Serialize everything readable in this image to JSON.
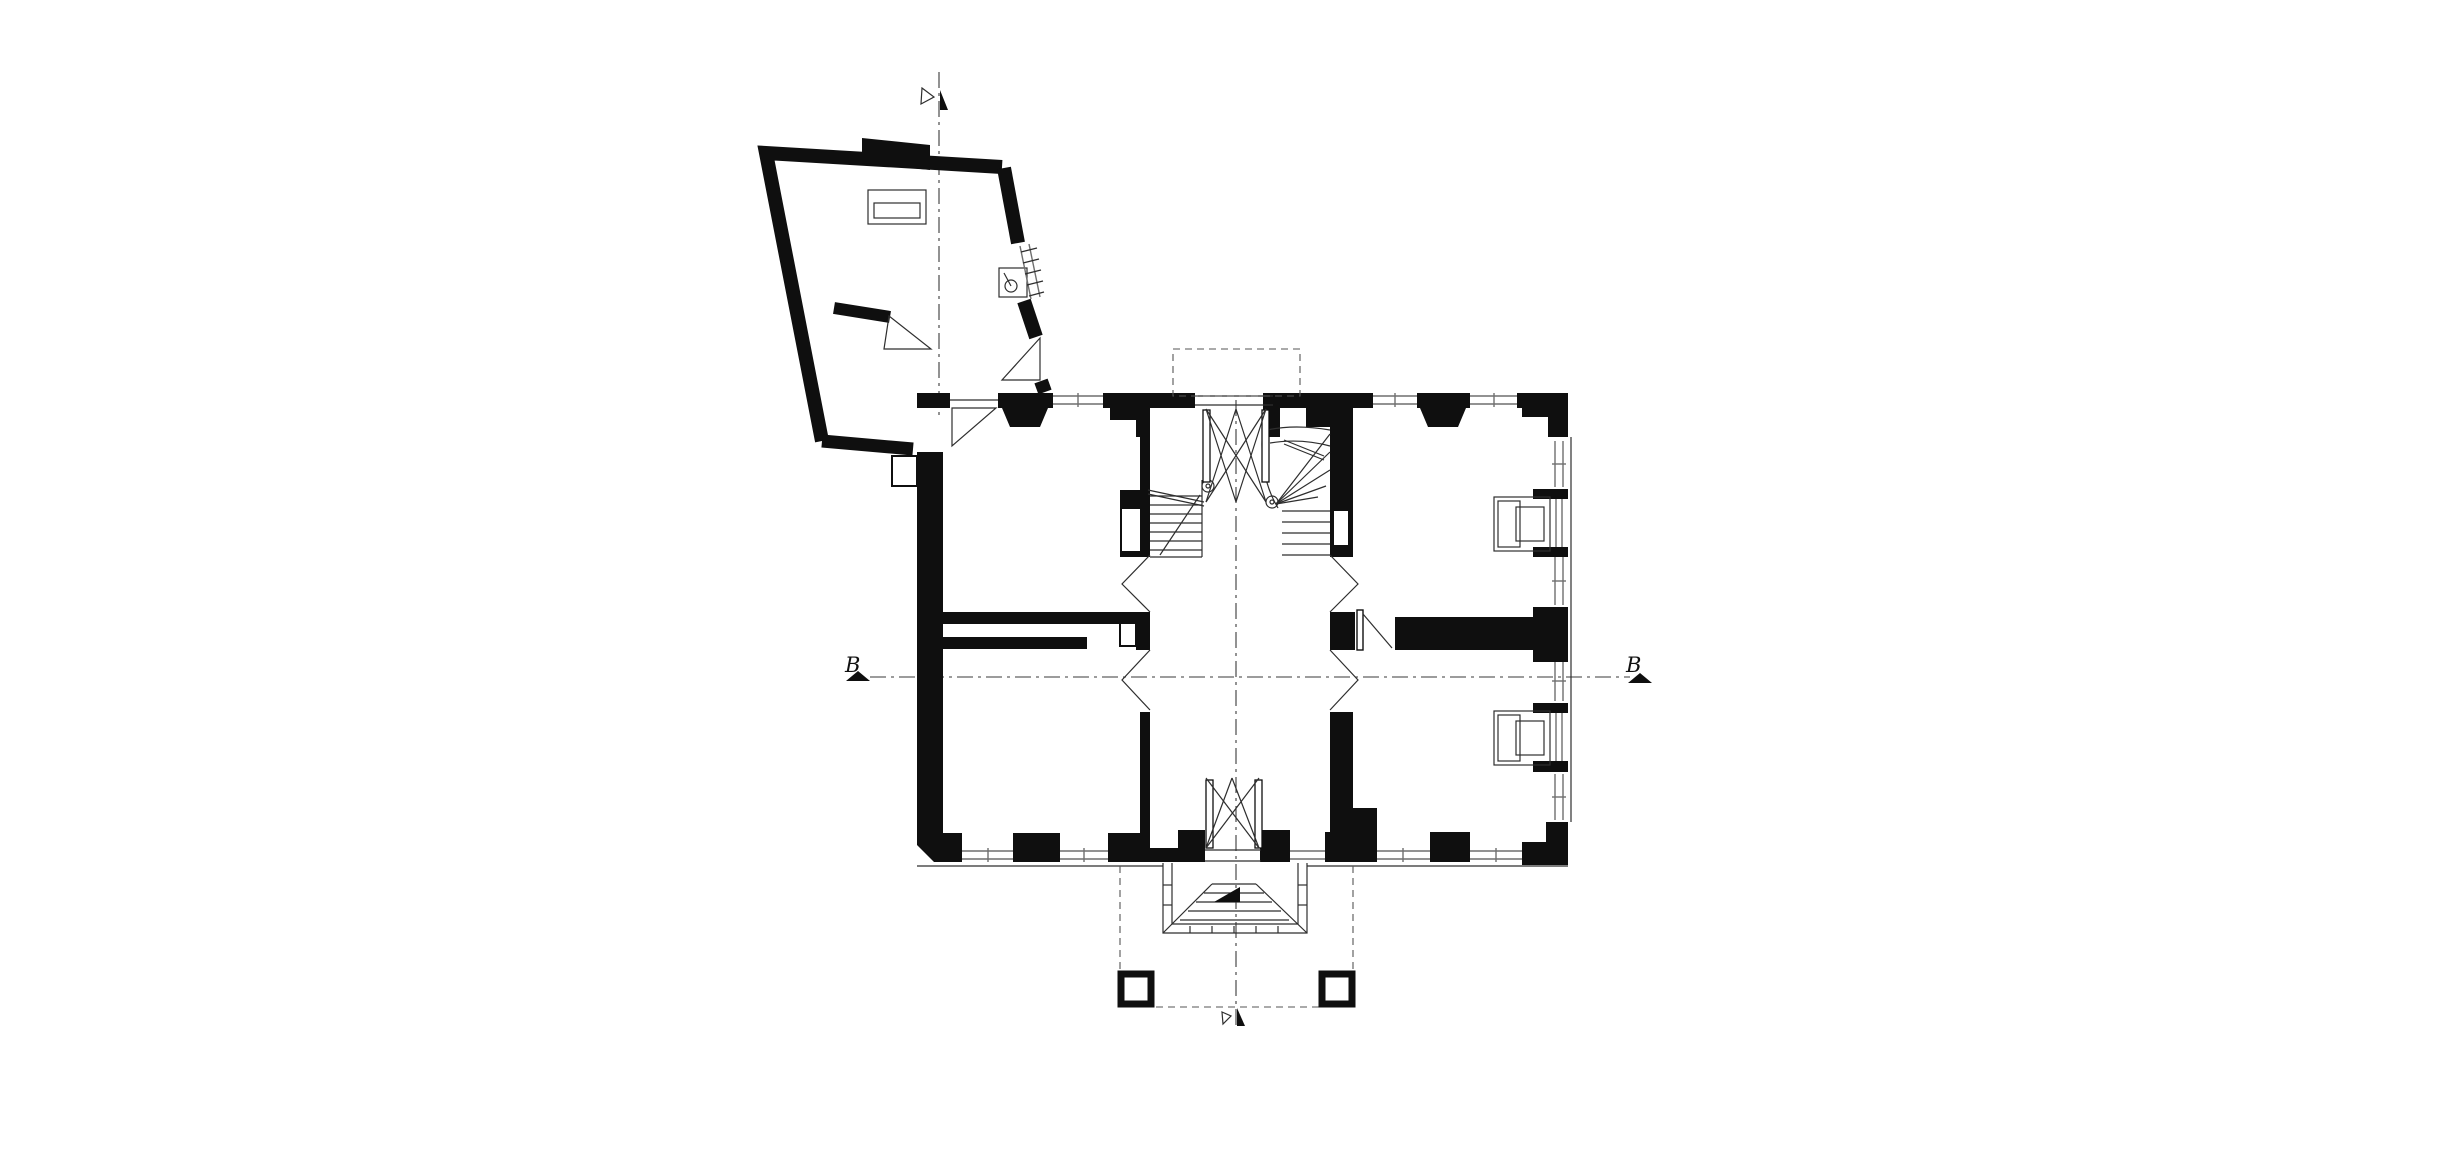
{
  "drawing": {
    "type": "architectural floor plan",
    "bg_color": "#ffffff",
    "wall_color": "#0f0f0f",
    "thin_line_color": "#2e2e2e",
    "window_line_color": "#6f6f6f",
    "axis_line_color": "#3a3a3a"
  },
  "section_markers": {
    "left": {
      "label": "B",
      "shape": "filled-triangle"
    },
    "right": {
      "label": "B",
      "shape": "filled-triangle"
    },
    "top": {
      "label": "",
      "shape": "open-and-filled-triangle"
    },
    "bottom": {
      "label": "",
      "shape": "open-and-filled-triangle"
    }
  },
  "components": [
    "annex-wing",
    "main-block",
    "central-hall",
    "vestibule",
    "stair-straight-flight",
    "stair-winder-flight",
    "upper-left-room",
    "lower-left-room",
    "upper-right-room",
    "lower-right-room",
    "tiled-stove-upper",
    "tiled-stove-lower",
    "masonry-stove-annex",
    "sink-symbol",
    "entrance-steps",
    "terrace-piers",
    "garden-porch-outline",
    "window-band",
    "door-swing",
    "section-axis"
  ]
}
